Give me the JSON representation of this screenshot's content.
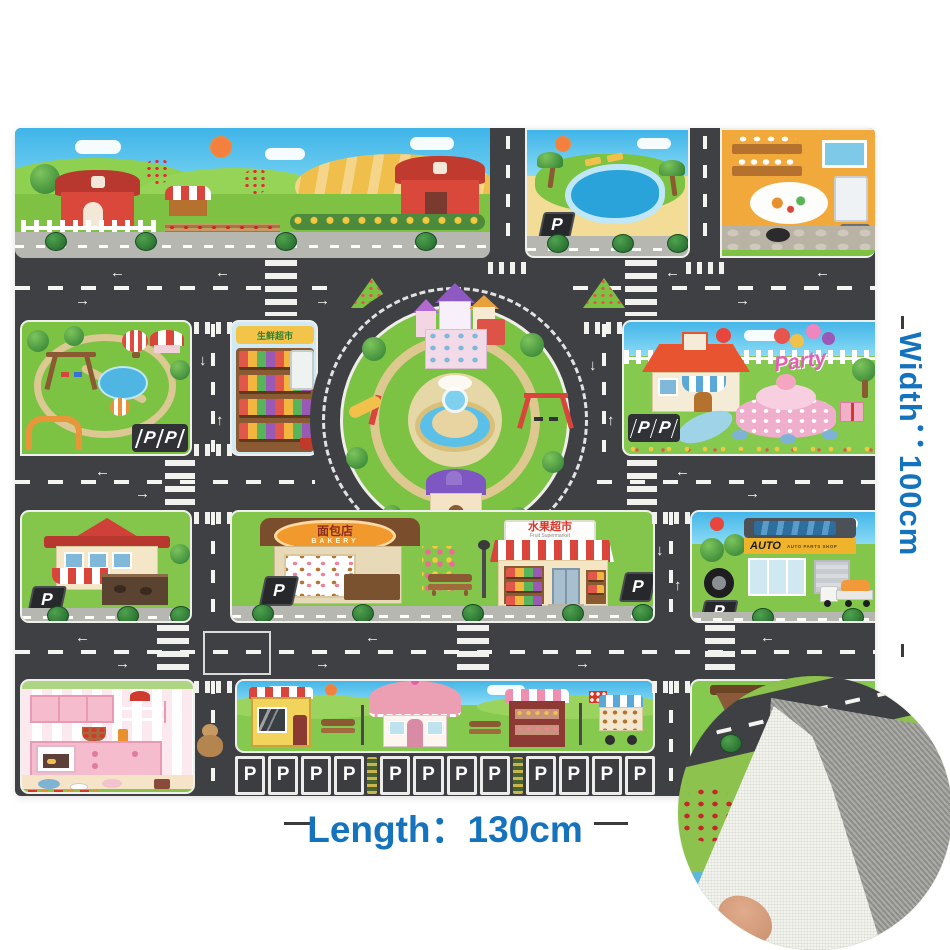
{
  "labels": {
    "width": "Width：100cm",
    "length": "Length：130cm"
  },
  "glyphs": {
    "left": "←",
    "right": "→",
    "up": "↑",
    "down": "↓"
  },
  "signs": {
    "p": "P",
    "market_cn": "生鲜超市",
    "bakery_cn": "面包店",
    "bakery_en": "BAKERY",
    "fruit_cn": "水果超市",
    "fruit_en": "Fruit Supermarket",
    "auto_main": "AUTO",
    "auto_sub": "AUTO PARTS SHOP",
    "party": "Party"
  },
  "parking": {
    "park_pp": [
      "P",
      "P"
    ],
    "party_pp": [
      "P",
      "P"
    ],
    "row_groups": [
      [
        "P",
        "P",
        "P",
        "P"
      ],
      [
        "P",
        "P",
        "P",
        "P"
      ],
      [
        "P",
        "P",
        "P",
        "P"
      ]
    ]
  },
  "colors": {
    "label_blue": "#1573bd",
    "road": "#3e4044",
    "grass": "#7fc142",
    "sky": "#46b7e8",
    "mat_border": "#efefec"
  }
}
